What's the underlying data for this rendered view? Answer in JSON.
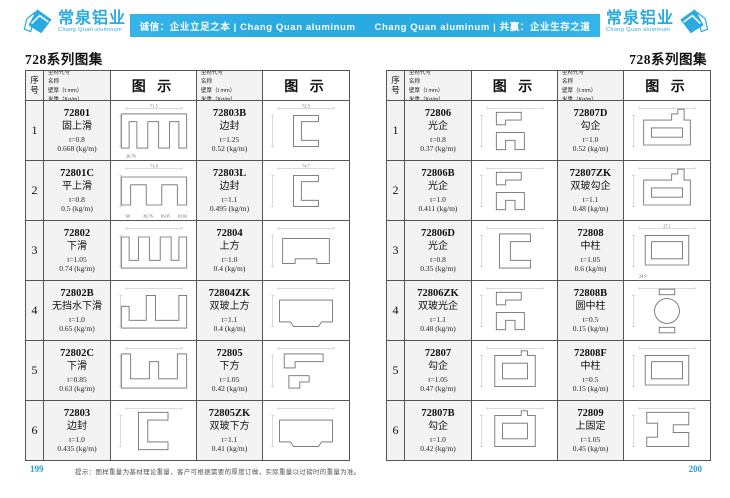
{
  "header": {
    "logo": {
      "name": "常泉铝业",
      "sub": "Chang Quan aluminum"
    },
    "banner_left": "诚信：企业立足之本 | Chang Quan aluminum",
    "banner_right": "Chang Quan aluminum | 共赢：企业生存之道"
  },
  "page_left": {
    "title": "728系列图集",
    "page_number": "199",
    "footer_note": "提示：图样重量为基材理论重量，客户可根据需要的厚度订做，实际重量以过磅时的重量为准。"
  },
  "page_right": {
    "title": "728系列图集",
    "page_number": "200"
  },
  "table_header": {
    "seq": "序号",
    "spec_lines": [
      "型材代号",
      "名称",
      "壁厚（t mm）",
      "米重（Kg/m）"
    ],
    "figure": "图 示"
  },
  "colors": {
    "accent": "#29abe2",
    "page_number": "#2a9fd8"
  },
  "left_table": [
    {
      "seq": "1",
      "cells": [
        {
          "code": "72801",
          "name": "固上滑",
          "thickness": "t=0.8",
          "weight": "0.668 (kg/m)",
          "shape": "hatDown",
          "dims": [
            "71.5",
            "26.76"
          ]
        },
        {
          "code": "72803B",
          "name": "边封",
          "thickness": "t=1.25",
          "weight": "0.52 (kg/m)",
          "shape": "cChannelSmall",
          "dims": [
            "72.5"
          ]
        }
      ]
    },
    {
      "seq": "2",
      "cells": [
        {
          "code": "72801C",
          "name": "平上滑",
          "thickness": "t=0.8",
          "weight": "0.5 (kg/m)",
          "shape": "hatDownFlat",
          "dims": [
            "71.9",
            "60",
            "26.76",
            "16.05",
            "10.03"
          ]
        },
        {
          "code": "72803L",
          "name": "边封",
          "thickness": "t=1.1",
          "weight": "0.495 (kg/m)",
          "shape": "cChannelSmall",
          "dims": [
            "74.7"
          ]
        }
      ]
    },
    {
      "seq": "3",
      "cells": [
        {
          "code": "72802",
          "name": "下滑",
          "thickness": "t=1.05",
          "weight": "0.74 (kg/m)",
          "shape": "hatUp",
          "dims": []
        },
        {
          "code": "72804",
          "name": "上方",
          "thickness": "t=1.0",
          "weight": "0.4 (kg/m)",
          "shape": "tubeNotch",
          "dims": []
        }
      ]
    },
    {
      "seq": "4",
      "cells": [
        {
          "code": "72802B",
          "name": "无挡水下滑",
          "thickness": "t=1.0",
          "weight": "0.65 (kg/m)",
          "shape": "hatUpOpen",
          "dims": []
        },
        {
          "code": "72804ZK",
          "name": "双玻上方",
          "thickness": "t=1.1",
          "weight": "0.4 (kg/m)",
          "shape": "tubeWide",
          "dims": []
        }
      ]
    },
    {
      "seq": "5",
      "cells": [
        {
          "code": "72802C",
          "name": "下滑",
          "thickness": "t=0.85",
          "weight": "0.63 (kg/m)",
          "shape": "hatUp2",
          "dims": []
        },
        {
          "code": "72805",
          "name": "下方",
          "thickness": "t=1.05",
          "weight": "0.42 (kg/m)",
          "shape": "zPieces",
          "dims": []
        }
      ]
    },
    {
      "seq": "6",
      "cells": [
        {
          "code": "72803",
          "name": "边封",
          "thickness": "t=1.0",
          "weight": "0.435 (kg/m)",
          "shape": "cChannel",
          "dims": []
        },
        {
          "code": "72805ZK",
          "name": "双玻下方",
          "thickness": "t=1.1",
          "weight": "0.41 (kg/m)",
          "shape": "tubeWide",
          "dims": []
        }
      ]
    }
  ],
  "right_table": [
    {
      "seq": "1",
      "cells": [
        {
          "code": "72806",
          "name": "光企",
          "thickness": "t=0.8",
          "weight": "0.37 (kg/m)",
          "shape": "twoC",
          "dims": []
        },
        {
          "code": "72807D",
          "name": "勾企",
          "thickness": "t=1.0",
          "weight": "0.52 (kg/m)",
          "shape": "hookRectTop",
          "dims": []
        }
      ]
    },
    {
      "seq": "2",
      "cells": [
        {
          "code": "72806B",
          "name": "光企",
          "thickness": "t=1.0",
          "weight": "0.411 (kg/m)",
          "shape": "twoC",
          "dims": []
        },
        {
          "code": "72807ZK",
          "name": "双玻勾企",
          "thickness": "t=1.1",
          "weight": "0.48 (kg/m)",
          "shape": "hookRectTop",
          "dims": []
        }
      ]
    },
    {
      "seq": "3",
      "cells": [
        {
          "code": "72806D",
          "name": "光企",
          "thickness": "t=0.8",
          "weight": "0.35 (kg/m)",
          "shape": "cSlim",
          "dims": []
        },
        {
          "code": "72808",
          "name": "中柱",
          "thickness": "t=1.05",
          "weight": "0.6 (kg/m)",
          "shape": "rectPlain",
          "dims": [
            "27.1",
            "24.9"
          ]
        }
      ]
    },
    {
      "seq": "4",
      "cells": [
        {
          "code": "72806ZK",
          "name": "双玻光企",
          "thickness": "t=1.1",
          "weight": "0.48 (kg/m)",
          "shape": "twoC",
          "dims": []
        },
        {
          "code": "72808B",
          "name": "圆中柱",
          "thickness": "t=0.5",
          "weight": "0.15 (kg/m)",
          "shape": "roundPost",
          "dims": []
        }
      ]
    },
    {
      "seq": "5",
      "cells": [
        {
          "code": "72807",
          "name": "勾企",
          "thickness": "t=1.05",
          "weight": "0.47 (kg/m)",
          "shape": "hookRect",
          "dims": []
        },
        {
          "code": "72808F",
          "name": "中柱",
          "thickness": "t=0.5",
          "weight": "0.15 (kg/m)",
          "shape": "rectPlain",
          "dims": []
        }
      ]
    },
    {
      "seq": "6",
      "cells": [
        {
          "code": "72807B",
          "name": "勾企",
          "thickness": "t=1.0",
          "weight": "0.42 (kg/m)",
          "shape": "hookRect",
          "dims": []
        },
        {
          "code": "72809",
          "name": "上固定",
          "thickness": "t=1.05",
          "weight": "0.45 (kg/m)",
          "shape": "zShape",
          "dims": []
        }
      ]
    }
  ]
}
